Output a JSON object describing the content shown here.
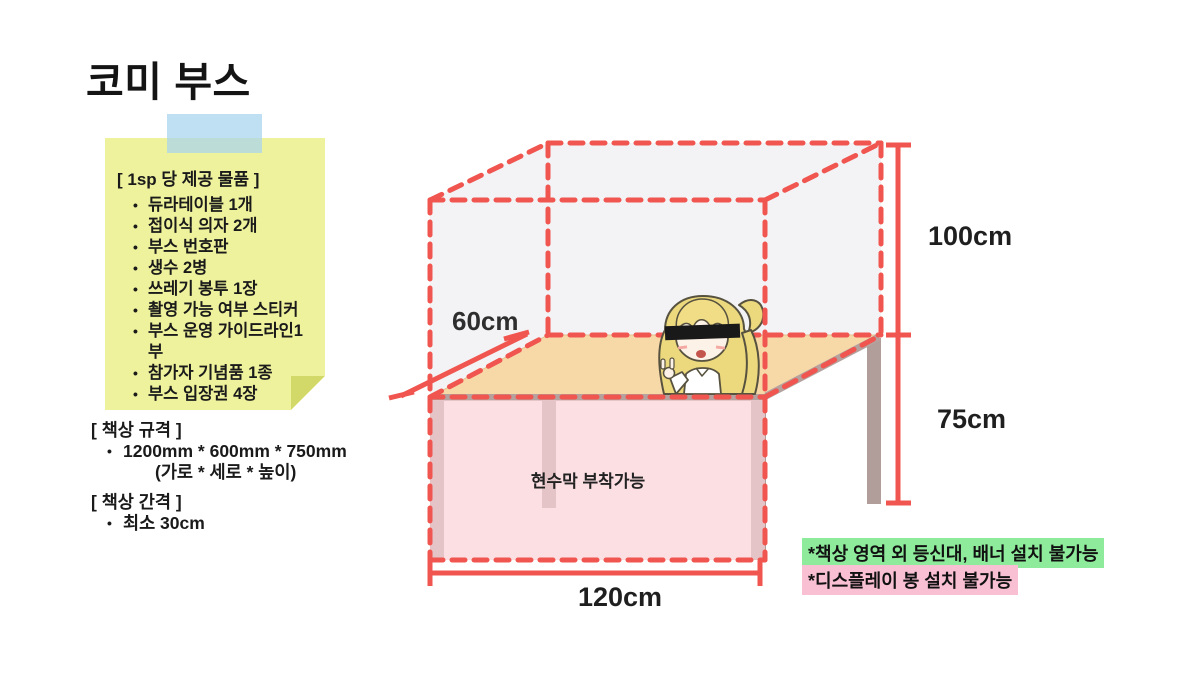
{
  "title": "코미 부스",
  "sticky_note": {
    "header": "[ 1sp 당 제공 물품 ]",
    "items": [
      "듀라테이블 1개",
      "접이식 의자 2개",
      "부스 번호판",
      "생수 2병",
      "쓰레기 봉투 1장",
      "촬영 가능 여부 스티커",
      "부스 운영 가이드라인1부",
      "참가자 기념품 1종",
      "부스 입장권 4장"
    ]
  },
  "desk_spec": {
    "header": "[ 책상 규격 ]",
    "size_line": "1200mm * 600mm * 750mm",
    "size_caption": "(가로 * 세로 * 높이)"
  },
  "desk_gap": {
    "header": "[ 책상 간격 ]",
    "item": "최소 30cm"
  },
  "diagram": {
    "dim_height_upper": "100cm",
    "dim_height_lower": "75cm",
    "dim_depth": "60cm",
    "dim_width": "120cm",
    "banner_label": "현수막 부착가능"
  },
  "restrictions": [
    {
      "text": "*책상 영역 외 등신대, 배너 설치 불가능",
      "highlight": "#8deb9b"
    },
    {
      "text": "*디스플레이 봉 설치 불가능",
      "highlight": "#f8c0d2"
    }
  ],
  "colors": {
    "accent_red": "#f0554f",
    "note_yellow": "#eff29c",
    "note_fold": "#d3d969",
    "tape_blue": "#a6d3ee",
    "table_top_tan": "#f7d9a8",
    "table_edge_gray": "#b5a29e",
    "leg_gray": "#b19e9a",
    "banner_pink": "#f9d3d8",
    "box_face_gray": "#f3f3f5",
    "highlight_green": "#8deb9b",
    "highlight_pink": "#f8c0d2"
  }
}
